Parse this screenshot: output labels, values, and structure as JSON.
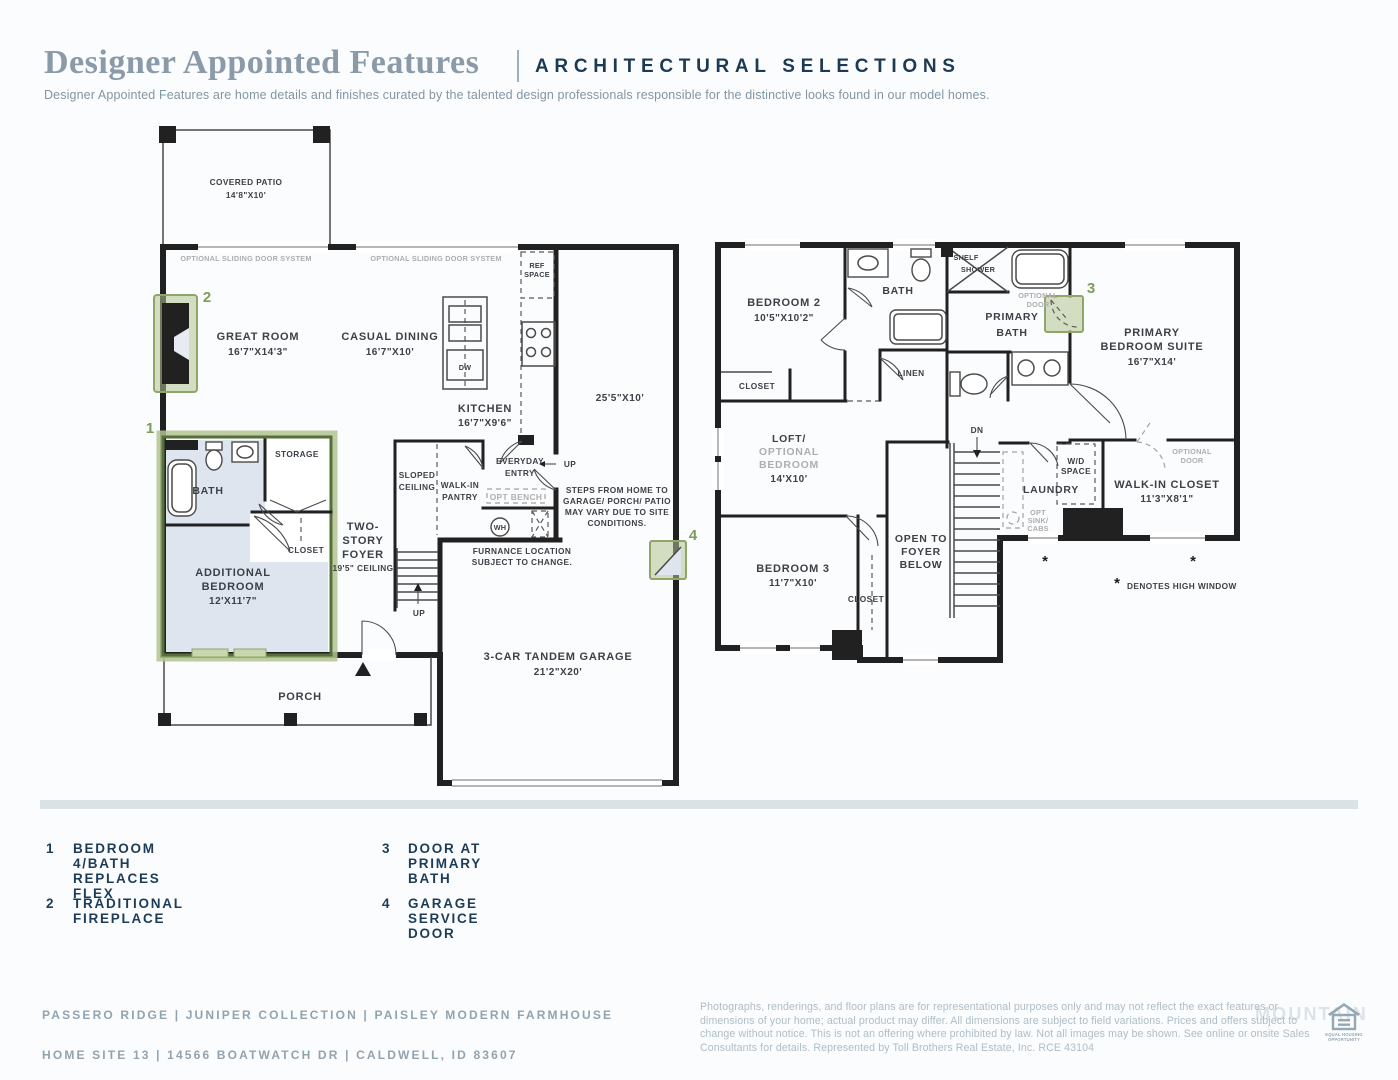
{
  "header": {
    "title": "Designer Appointed Features",
    "subtitle": "ARCHITECTURAL SELECTIONS",
    "tagline": "Designer Appointed Features are home details and finishes curated by the talented design professionals responsible for the distinctive looks found in our model homes."
  },
  "floor1": {
    "covered_patio_name": "COVERED PATIO",
    "covered_patio_dims": "14'8\"X10'",
    "sliding1": "OPTIONAL SLIDING DOOR SYSTEM",
    "sliding2": "OPTIONAL SLIDING DOOR SYSTEM",
    "ref1": "REF",
    "ref2": "SPACE",
    "great_room_name": "GREAT ROOM",
    "great_room_dims": "16'7\"X14'3\"",
    "casual_dining_name": "CASUAL DINING",
    "casual_dining_dims": "16'7\"X10'",
    "dw": "DW",
    "kitchen_name": "KITCHEN",
    "kitchen_dims": "16'7\"X9'6\"",
    "tandem_dims": "25'5\"X10'",
    "bath": "BATH",
    "storage": "STORAGE",
    "closet": "CLOSET",
    "addl1": "ADDITIONAL",
    "addl2": "BEDROOM",
    "addl_dims": "12'X11'7\"",
    "foyer1": "TWO-",
    "foyer2": "STORY",
    "foyer3": "FOYER",
    "foyer4": "19'5\" CEILING",
    "sloped1": "SLOPED",
    "sloped2": "CEILING",
    "pantry1": "WALK-IN",
    "pantry2": "PANTRY",
    "entry1": "EVERYDAY",
    "entry2": "ENTRY",
    "opt_bench": "OPT BENCH",
    "wh": "WH",
    "up": "UP",
    "furnace1": "FURNANCE LOCATION",
    "furnace2": "SUBJECT TO CHANGE.",
    "steps1": "STEPS FROM HOME TO",
    "steps2": "GARAGE/ PORCH/ PATIO",
    "steps3": "MAY VARY DUE TO SITE",
    "steps4": "CONDITIONS.",
    "garage_name": "3-CAR TANDEM GARAGE",
    "garage_dims": "21'2\"X20'",
    "porch": "PORCH",
    "m1": "1",
    "m2": "2",
    "m4": "4"
  },
  "floor2": {
    "bedroom2_name": "BEDROOM 2",
    "bedroom2_dims": "10'5\"X10'2\"",
    "bath": "BATH",
    "shelf": "SHELF",
    "shower": "SHOWER",
    "primary_bath1": "PRIMARY",
    "primary_bath2": "BATH",
    "opt_door1": "OPTIONAL",
    "opt_door2": "DOOR",
    "suite1": "PRIMARY",
    "suite2": "BEDROOM SUITE",
    "suite_dims": "16'7\"X14'",
    "closet": "CLOSET",
    "linen": "LINEN",
    "loft1": "LOFT/",
    "loft2": "OPTIONAL",
    "loft3": "BEDROOM",
    "loft_dims": "14'X10'",
    "dn": "DN",
    "open1": "OPEN TO",
    "open2": "FOYER",
    "open3": "BELOW",
    "bedroom3_name": "BEDROOM 3",
    "bedroom3_dims": "11'7\"X10'",
    "wd1": "W/D",
    "wd2": "SPACE",
    "laundry": "LAUNDRY",
    "opt_sink1": "OPT",
    "opt_sink2": "SINK/",
    "opt_sink3": "CABS",
    "wic_name": "WALK-IN CLOSET",
    "wic_dims": "11'3\"X8'1\"",
    "star": "*",
    "high_window": "DENOTES HIGH WINDOW",
    "m3": "3"
  },
  "legend": {
    "items": [
      {
        "num": "1",
        "label": "BEDROOM 4/BATH REPLACES FLEX"
      },
      {
        "num": "2",
        "label": "TRADITIONAL FIREPLACE"
      },
      {
        "num": "3",
        "label": "DOOR AT PRIMARY BATH"
      },
      {
        "num": "4",
        "label": "GARAGE SERVICE DOOR"
      }
    ]
  },
  "footer": {
    "left_line1": "PASSERO RIDGE   |   JUNIPER COLLECTION   |   PAISLEY MODERN FARMHOUSE",
    "left_line2": "HOME SITE 13   |   14566 BOATWATCH DR   |   CALDWELL, ID 83607",
    "disclaimer": "Photographs, renderings, and floor plans are for representational purposes only and may not reflect the exact features or dimensions of your home; actual product may differ. All dimensions are subject to field variations. Prices and offers subject to change without notice. This is not an offering where prohibited by law. Not all images may be shown. See online or onsite Sales Consultants for details. Represented by Toll Brothers Real Estate, Inc. RCE 43104",
    "watermark": "MOUNTAIN",
    "eho1": "EQUAL HOUSING",
    "eho2": "OPPORTUNITY"
  },
  "colors": {
    "accent_navy": "#1d3a54",
    "muted_blue": "#8a9aa8",
    "highlight_green": "#8fa668",
    "room_fill_blue": "#dfe5ef",
    "divider": "#dbe2e6"
  }
}
